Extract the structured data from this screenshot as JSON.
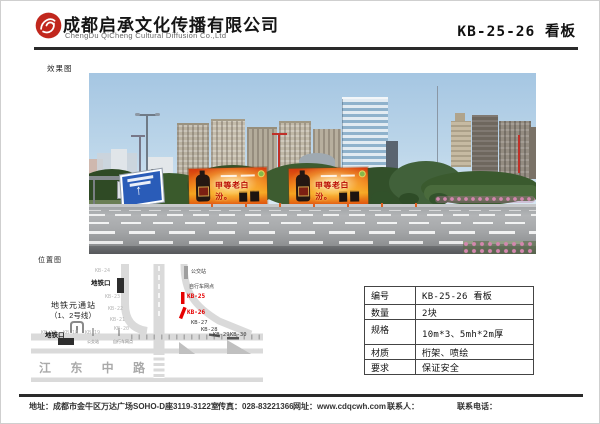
{
  "header": {
    "company_cn": "成都启承文化传播有限公司",
    "company_en": "ChengDu QiCheng Cultural Diffusion Co.,Ltd",
    "doc_title": "KB-25-26 看板",
    "logo_color": "#c1271d"
  },
  "photo_section": {
    "label": "效果图",
    "billboard_text": "甲等老白汾。"
  },
  "map_section": {
    "label": "位置图",
    "road_name": "江 东 中 路",
    "station_name": "地铁元通站",
    "station_lines": "（1、2号线）",
    "metro_exit_top": "地铁口",
    "metro_exit_bottom": "地铁口",
    "bus_stop": "公交站",
    "bike_point": "自行车网点",
    "small_bus_stop": "公交站",
    "small_bike_point": "自行车网点",
    "markers": {
      "kb17": "KB-17",
      "kb18": "KB-18",
      "kb19": "KB-19",
      "kb20": "KB-20",
      "kb21": "KB-21",
      "kb22": "KB-22",
      "kb23": "KB-23",
      "kb24": "KB-24",
      "kb25": "KB-25",
      "kb26": "KB-26",
      "kb27": "KB-27",
      "kb28": "KB-28",
      "kb29": "KB-29",
      "kb30": "KB-30"
    },
    "marker_red_color": "#e60000"
  },
  "info_table": {
    "rows": [
      {
        "label": "编号",
        "value": "KB-25-26 看板"
      },
      {
        "label": "数量",
        "value": "2块"
      },
      {
        "label": "规格",
        "value": "10m*3、5mh*2m厚"
      },
      {
        "label": "材质",
        "value": "桁架、喷绘"
      },
      {
        "label": "要求",
        "value": "保证安全"
      }
    ]
  },
  "footer": {
    "address_label": "地址：",
    "address": "成都市金牛区万达广场SOHO-D座3119-3122室",
    "fax_label": "传真：",
    "fax": "028-83221366",
    "web_label": "网址：",
    "web": "www.cdqcwh.com",
    "contact_label": "联系人：",
    "phone_label": "联系电话："
  },
  "colors": {
    "billboard_orange": "#ee7d15",
    "rule_black": "#2a2a2a",
    "sign_blue": "#2a5cb8"
  }
}
